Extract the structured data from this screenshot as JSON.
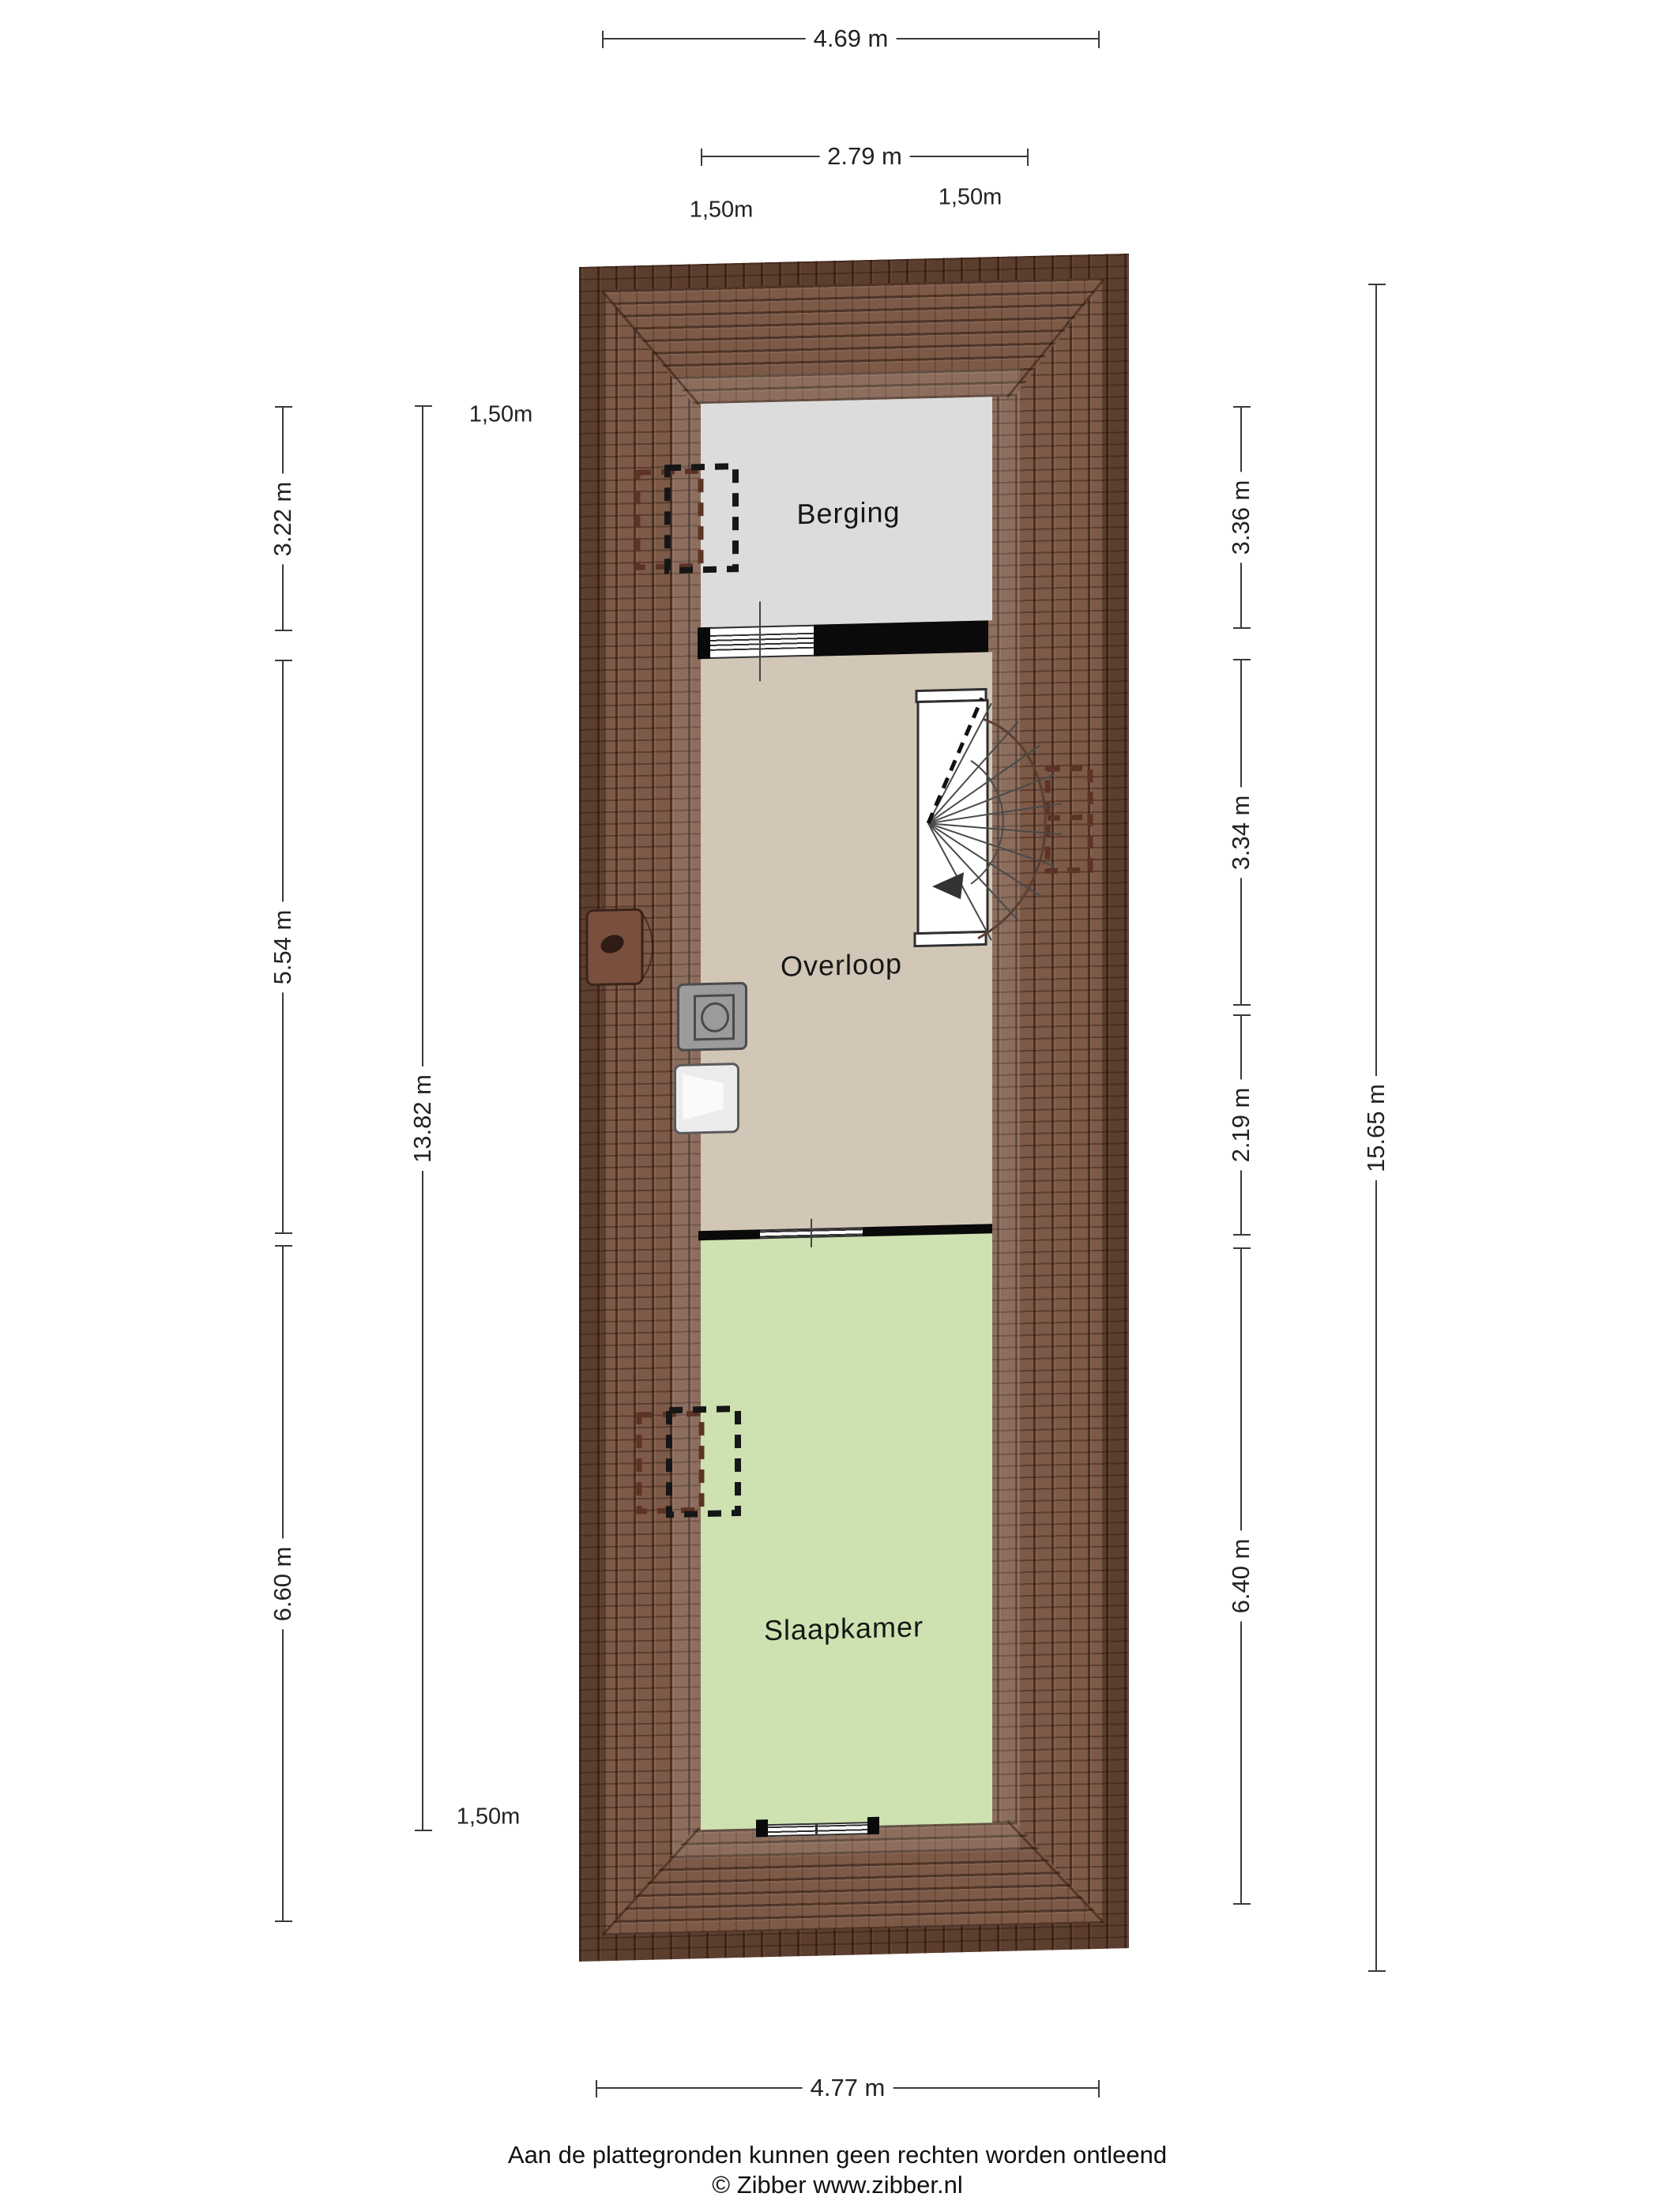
{
  "plan_title": "attic floor plan",
  "rooms": {
    "berging": {
      "label": "Berging"
    },
    "overloop": {
      "label": "Overloop"
    },
    "slaapkamer": {
      "label": "Slaapkamer"
    }
  },
  "dims": {
    "top_width": "4.69 m",
    "top_inner_width": "2.79 m",
    "top_left_offset": "1,50m",
    "top_right_offset": "1,50m",
    "left_berging": "3.22 m",
    "left_overloop": "5.54 m",
    "left_slaapkamer": "6.60 m",
    "left_total": "13.82 m",
    "left_top_offset": "1,50m",
    "left_bottom_offset": "1,50m",
    "right_berging": "3.36 m",
    "right_overloop_top": "3.34 m",
    "right_overloop_bottom": "2.19 m",
    "right_slaapkamer": "6.40 m",
    "right_total": "15.65 m",
    "bottom_width": "4.77 m"
  },
  "footer": {
    "disclaimer": "Aan de plattegronden kunnen geen rechten worden ontleend",
    "copyright": "© Zibber www.zibber.nl"
  },
  "colors": {
    "roof_base": "#7d5947",
    "berging": "#dcdcdc",
    "overloop": "#d2c6b6",
    "slaapkamer": "#cde2b0",
    "wall": "#0a0a0a",
    "dim_line": "#3a3a3a"
  }
}
